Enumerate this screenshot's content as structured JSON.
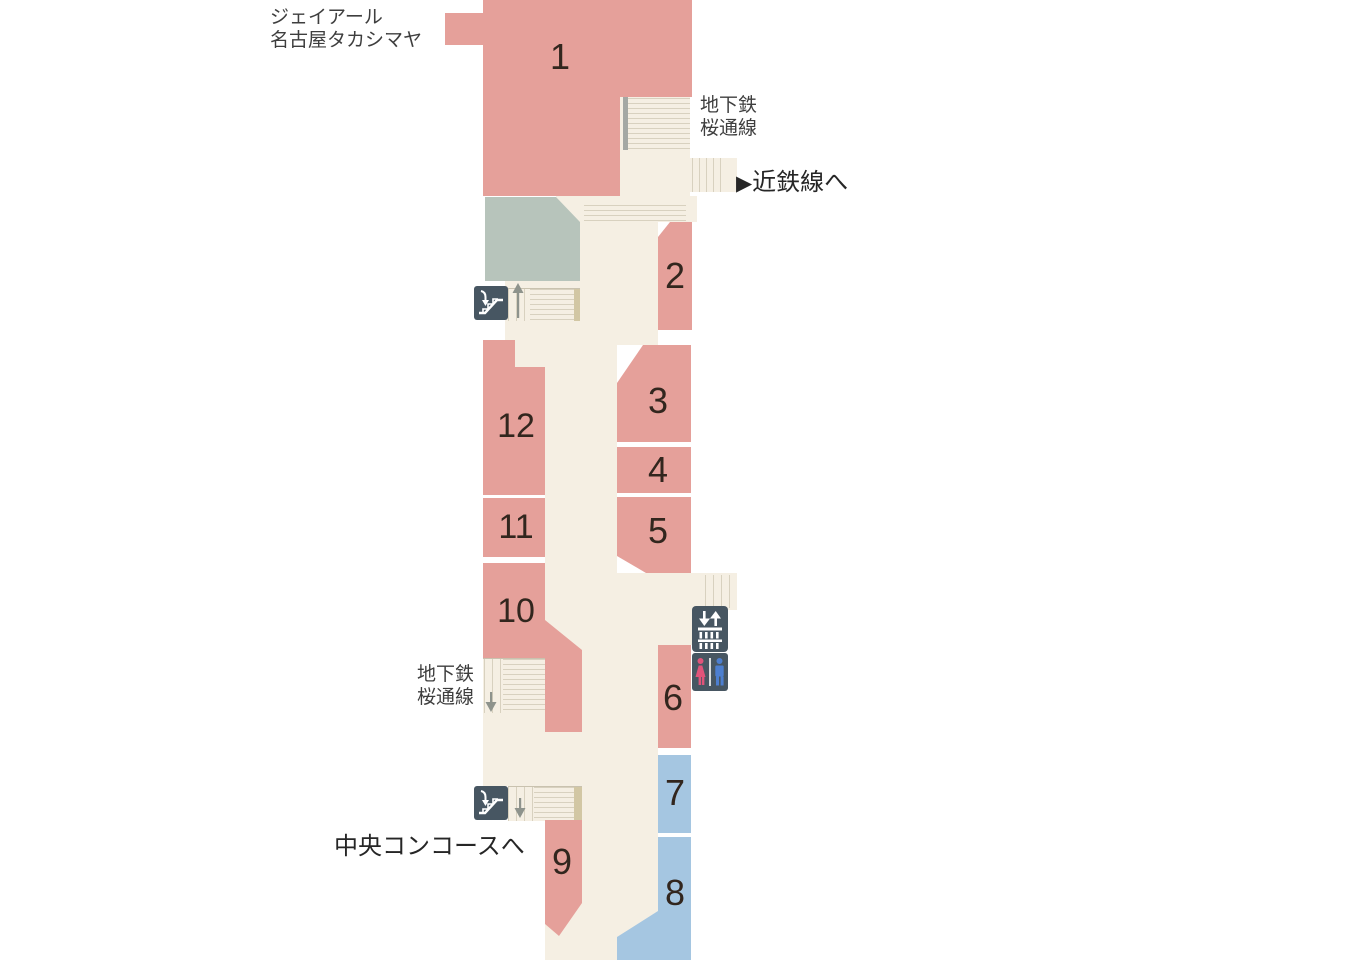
{
  "map": {
    "region_labels": {
      "jr_takashimaya_line1": "ジェイアール",
      "jr_takashimaya_line2": "名古屋タカシマヤ",
      "subway_sakuradori_top_line1": "地下鉄",
      "subway_sakuradori_top_line2": "桜通線",
      "subway_sakuradori_left_line1": "地下鉄",
      "subway_sakuradori_left_line2": "桜通線",
      "to_kintetsu_arrow": "▶",
      "to_kintetsu": "近鉄線へ",
      "to_central_concourse": "中央コンコースへ"
    },
    "blocks": {
      "b1": {
        "label": "1"
      },
      "b2": {
        "label": "2"
      },
      "b3": {
        "label": "3"
      },
      "b4": {
        "label": "4"
      },
      "b5": {
        "label": "5"
      },
      "b6": {
        "label": "6"
      },
      "b7": {
        "label": "7"
      },
      "b8": {
        "label": "8"
      },
      "b9": {
        "label": "9"
      },
      "b10": {
        "label": "10"
      },
      "b11": {
        "label": "11"
      },
      "b12": {
        "label": "12"
      }
    },
    "icons": {
      "escalator_upper": "escalator-icon",
      "escalator_lower": "escalator-icon",
      "ticket_gate": "ticket-gate-icon",
      "restroom": "restroom-icon",
      "stairs_up_arrow": "up-arrow-icon",
      "stairs_down_arrow_sakuradori": "down-arrow-icon",
      "stairs_down_arrow_lower": "down-arrow-icon"
    },
    "colors": {
      "platform_pink": "#e5a09a",
      "platform_blue": "#a5c6e1",
      "area_green": "#b7c4bb",
      "walkway_cream": "#f5efe3",
      "stair_line": "#d8d1bf",
      "stair_edge_tan": "#d2c7a4",
      "icon_bg_slate": "#475662",
      "restroom_female": "#e0547a",
      "restroom_male": "#4d7fd0",
      "text_dark": "#262626",
      "text_gray": "#3e3e3e",
      "number_dark": "#32261e"
    }
  }
}
